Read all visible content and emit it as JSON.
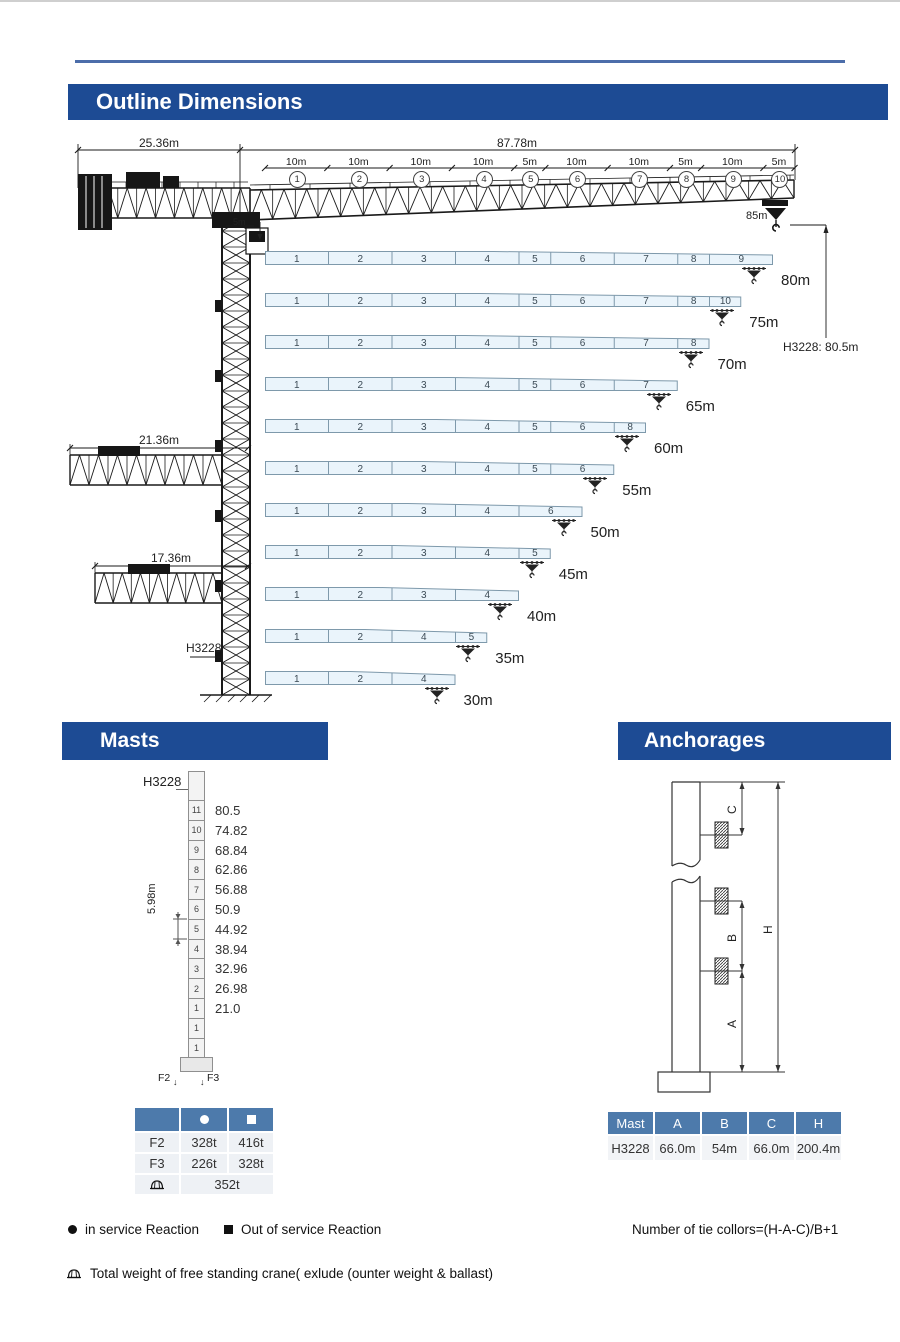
{
  "outline": {
    "title": "Outline Dimensions",
    "counter_jib_dim": "25.36m",
    "jib_dim": "87.78m",
    "tip_label": "85m",
    "tower_height_label": "H3228: 80.5m",
    "jib_root_label": "5m",
    "tower_label": "H3228",
    "counter_jib_variants": [
      {
        "label": "21.36m"
      },
      {
        "label": "17.36m"
      }
    ],
    "jib_segments": [
      {
        "no": "1",
        "len": "10m",
        "m": 10
      },
      {
        "no": "2",
        "len": "10m",
        "m": 10
      },
      {
        "no": "3",
        "len": "10m",
        "m": 10
      },
      {
        "no": "4",
        "len": "10m",
        "m": 10
      },
      {
        "no": "5",
        "len": "5m",
        "m": 5
      },
      {
        "no": "6",
        "len": "10m",
        "m": 10
      },
      {
        "no": "7",
        "len": "10m",
        "m": 10
      },
      {
        "no": "8",
        "len": "5m",
        "m": 5
      },
      {
        "no": "9",
        "len": "10m",
        "m": 10
      },
      {
        "no": "10",
        "len": "5m",
        "m": 5
      }
    ],
    "jib_configs": [
      {
        "label": "80m",
        "segments": [
          [
            "1",
            10
          ],
          [
            "2",
            10
          ],
          [
            "3",
            10
          ],
          [
            "4",
            10
          ],
          [
            "5",
            5
          ],
          [
            "6",
            10
          ],
          [
            "7",
            10
          ],
          [
            "8",
            5
          ],
          [
            "9",
            10
          ]
        ]
      },
      {
        "label": "75m",
        "segments": [
          [
            "1",
            10
          ],
          [
            "2",
            10
          ],
          [
            "3",
            10
          ],
          [
            "4",
            10
          ],
          [
            "5",
            5
          ],
          [
            "6",
            10
          ],
          [
            "7",
            10
          ],
          [
            "8",
            5
          ],
          [
            "10",
            5
          ]
        ]
      },
      {
        "label": "70m",
        "segments": [
          [
            "1",
            10
          ],
          [
            "2",
            10
          ],
          [
            "3",
            10
          ],
          [
            "4",
            10
          ],
          [
            "5",
            5
          ],
          [
            "6",
            10
          ],
          [
            "7",
            10
          ],
          [
            "8",
            5
          ]
        ]
      },
      {
        "label": "65m",
        "segments": [
          [
            "1",
            10
          ],
          [
            "2",
            10
          ],
          [
            "3",
            10
          ],
          [
            "4",
            10
          ],
          [
            "5",
            5
          ],
          [
            "6",
            10
          ],
          [
            "7",
            10
          ]
        ]
      },
      {
        "label": "60m",
        "segments": [
          [
            "1",
            10
          ],
          [
            "2",
            10
          ],
          [
            "3",
            10
          ],
          [
            "4",
            10
          ],
          [
            "5",
            5
          ],
          [
            "6",
            10
          ],
          [
            "8",
            5
          ]
        ]
      },
      {
        "label": "55m",
        "segments": [
          [
            "1",
            10
          ],
          [
            "2",
            10
          ],
          [
            "3",
            10
          ],
          [
            "4",
            10
          ],
          [
            "5",
            5
          ],
          [
            "6",
            10
          ]
        ]
      },
      {
        "label": "50m",
        "segments": [
          [
            "1",
            10
          ],
          [
            "2",
            10
          ],
          [
            "3",
            10
          ],
          [
            "4",
            10
          ],
          [
            "6",
            10
          ]
        ]
      },
      {
        "label": "45m",
        "segments": [
          [
            "1",
            10
          ],
          [
            "2",
            10
          ],
          [
            "3",
            10
          ],
          [
            "4",
            10
          ],
          [
            "5",
            5
          ]
        ]
      },
      {
        "label": "40m",
        "segments": [
          [
            "1",
            10
          ],
          [
            "2",
            10
          ],
          [
            "3",
            10
          ],
          [
            "4",
            10
          ]
        ]
      },
      {
        "label": "35m",
        "segments": [
          [
            "1",
            10
          ],
          [
            "2",
            10
          ],
          [
            "4",
            10
          ],
          [
            "5",
            5
          ]
        ]
      },
      {
        "label": "30m",
        "segments": [
          [
            "1",
            10
          ],
          [
            "2",
            10
          ],
          [
            "4",
            10
          ]
        ]
      }
    ]
  },
  "masts": {
    "title": "Masts",
    "mast_label": "H3228",
    "section_dim": "5.98m",
    "sections": [
      {
        "no": "11",
        "height": "80.5"
      },
      {
        "no": "10",
        "height": "74.82"
      },
      {
        "no": "9",
        "height": "68.84"
      },
      {
        "no": "8",
        "height": "62.86"
      },
      {
        "no": "7",
        "height": "56.88"
      },
      {
        "no": "6",
        "height": "50.9"
      },
      {
        "no": "5",
        "height": "44.92"
      },
      {
        "no": "4",
        "height": "38.94"
      },
      {
        "no": "3",
        "height": "32.96"
      },
      {
        "no": "2",
        "height": "26.98"
      },
      {
        "no": "1",
        "height": "21.0"
      },
      {
        "no": "1",
        "height": ""
      },
      {
        "no": "1",
        "height": ""
      }
    ],
    "base_labels": [
      "F2",
      "F3"
    ],
    "table": {
      "header_icons": [
        "circle",
        "square"
      ],
      "rows": [
        {
          "label": "F2",
          "circle": "328t",
          "square": "416t"
        },
        {
          "label": "F3",
          "circle": "226t",
          "square": "328t"
        }
      ],
      "total_row": {
        "icon": "crane-weight",
        "value": "352t"
      }
    }
  },
  "anchorages": {
    "title": "Anchorages",
    "dim_labels": {
      "a": "A",
      "b": "B",
      "c": "C",
      "h": "H"
    },
    "table": {
      "headers": [
        "Mast",
        "A",
        "B",
        "C",
        "H"
      ],
      "rows": [
        [
          "H3228",
          "66.0m",
          "54m",
          "66.0m",
          "200.4m"
        ]
      ]
    }
  },
  "legend": {
    "in_service": "in service Reaction",
    "out_service": "Out of service Reaction",
    "tie_formula": "Number of tie collors=(H-A-C)/B+1",
    "total_weight": "Total weight of free standing crane( exlude (ounter weight & ballast)"
  },
  "colors": {
    "header_blue": "#1d4b94",
    "table_header_blue": "#4d7aab",
    "bar_fill": "#eaf4fb",
    "bar_border": "#7e99ab",
    "ink": "#1a1a1a"
  }
}
